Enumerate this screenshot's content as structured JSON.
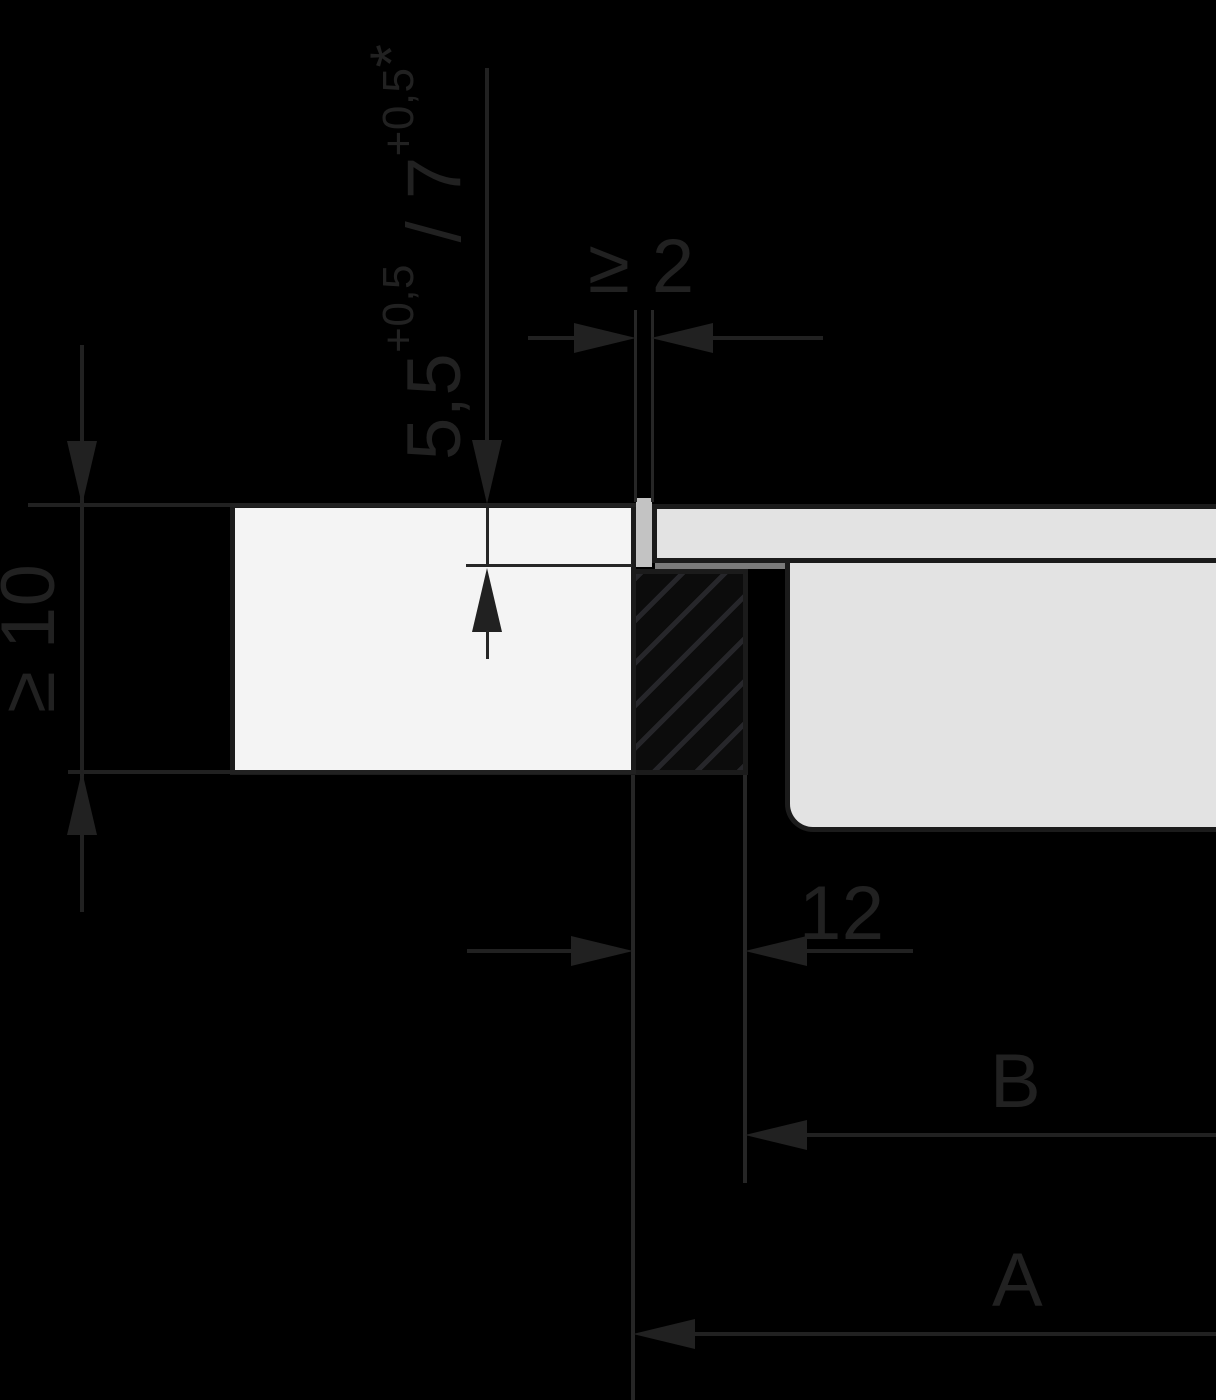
{
  "dimensions": {
    "recess_depth": {
      "value_1": "5,5",
      "tolerance_1": "+0,5",
      "separator": " / ",
      "value_2": "7",
      "tolerance_2": "+0,5",
      "footnote_marker": "*"
    },
    "joint_gap_min": "≥ 2",
    "countertop_thickness_min": "≥ 10",
    "ledge_offset": "12",
    "ref_b": "B",
    "ref_a": "A"
  },
  "colors": {
    "background": "#000000",
    "dimension_lines_text": "#212121",
    "shape_outline": "#1b1b1b",
    "countertop_fill": "#f4f4f4",
    "appliance_fill": "#e3e3e3",
    "joint_filler_fill": "#c3c3c3",
    "frame_strip_fill": "#7b7b7b"
  }
}
